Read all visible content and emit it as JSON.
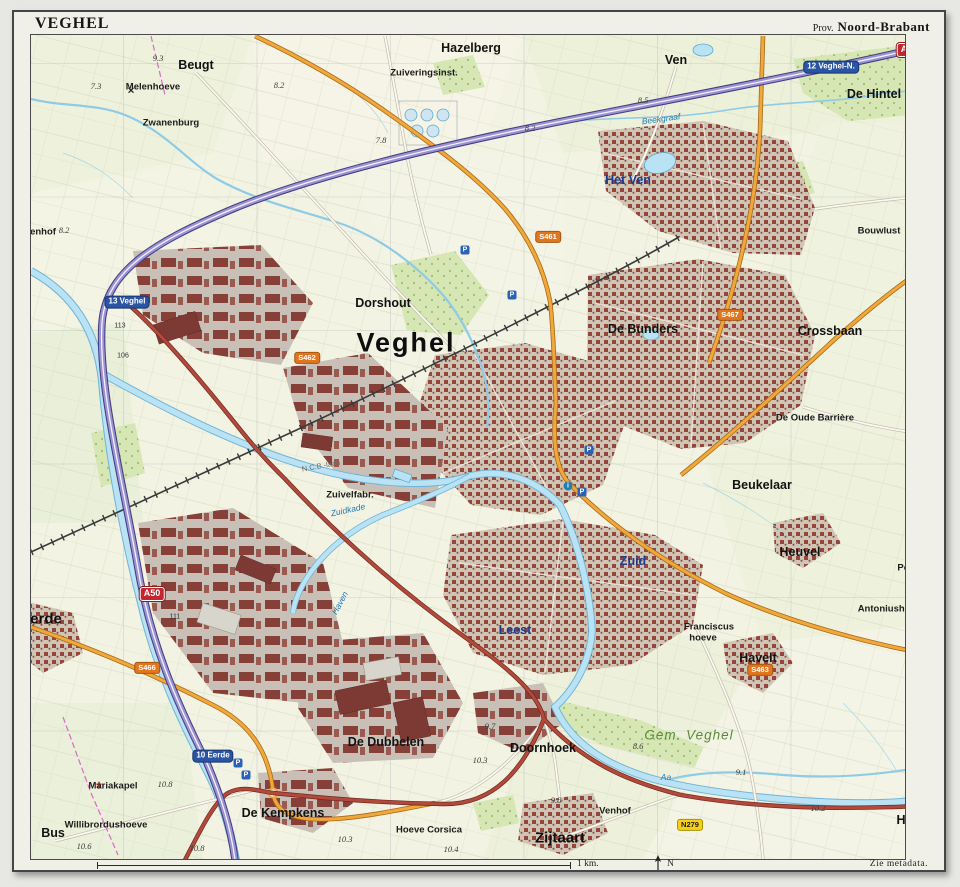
{
  "frame": {
    "title": "VEGHEL",
    "province_prefix": "Prov.",
    "province": "Noord-Brabant",
    "scale_label": "1 km.",
    "north_label": "N",
    "metadata_note": "Zie metadata."
  },
  "colors": {
    "paper": "#f1f0e8",
    "map_base": "#f2f3e3",
    "urban_red": "#96453d",
    "industry_red": "#874038",
    "water": "#b9e3f4",
    "water_edge": "#6fb4d4",
    "motorway_purple": "#9a92d2",
    "main_road_red": "#b3493a",
    "regional_road_orange": "#f0a83d",
    "forest_green": "#d6e6b4",
    "a_shield_red": "#c4262d",
    "n_shield_yellow": "#f6d016",
    "s_shield_orange": "#e2761f",
    "exit_shield_blue": "#2a55a5"
  },
  "map": {
    "labels": [
      {
        "t": "Veghel",
        "x": 403,
        "y": 340,
        "k": "town"
      },
      {
        "t": "Zijtaart",
        "x": 557,
        "y": 835,
        "k": "village"
      },
      {
        "t": "erde",
        "x": 43,
        "y": 616,
        "k": "village"
      },
      {
        "t": "Beugt",
        "x": 193,
        "y": 62,
        "k": "district"
      },
      {
        "t": "Hazelberg",
        "x": 468,
        "y": 45,
        "k": "district"
      },
      {
        "t": "Ven",
        "x": 673,
        "y": 57,
        "k": "district"
      },
      {
        "t": "De Hintel",
        "x": 871,
        "y": 91,
        "k": "district"
      },
      {
        "t": "Dorshout",
        "x": 380,
        "y": 300,
        "k": "district"
      },
      {
        "t": "De Bunders",
        "x": 640,
        "y": 326,
        "k": "district"
      },
      {
        "t": "Crossbaan",
        "x": 827,
        "y": 328,
        "k": "district"
      },
      {
        "t": "Beukelaar",
        "x": 759,
        "y": 482,
        "k": "district"
      },
      {
        "t": "Heuvel",
        "x": 797,
        "y": 549,
        "k": "district"
      },
      {
        "t": "Havelt",
        "x": 755,
        "y": 655,
        "k": "district"
      },
      {
        "t": "De Dubbelen",
        "x": 383,
        "y": 739,
        "k": "district"
      },
      {
        "t": "Doornhoek",
        "x": 540,
        "y": 745,
        "k": "district"
      },
      {
        "t": "De Kempkens",
        "x": 280,
        "y": 810,
        "k": "district"
      },
      {
        "t": "Bus",
        "x": 50,
        "y": 830,
        "k": "district"
      },
      {
        "t": "Ham",
        "x": 907,
        "y": 817,
        "k": "district"
      },
      {
        "t": "Het Ven",
        "x": 625,
        "y": 177,
        "k": "districtblue"
      },
      {
        "t": "Zuid",
        "x": 630,
        "y": 558,
        "k": "districtblue"
      },
      {
        "t": "Leest",
        "x": 512,
        "y": 627,
        "k": "districtblue"
      },
      {
        "t": "Gem. Veghel",
        "x": 686,
        "y": 732,
        "k": "muni"
      },
      {
        "t": "Bouwlust",
        "x": 876,
        "y": 228,
        "k": "hamlet"
      },
      {
        "t": "De Oude Barrière",
        "x": 812,
        "y": 415,
        "k": "hamlet"
      },
      {
        "t": "Pompstat",
        "x": 916,
        "y": 565,
        "k": "hamlet"
      },
      {
        "t": "Antoniushoeve",
        "x": 889,
        "y": 606,
        "k": "hamlet"
      },
      {
        "t": "Franciscus",
        "x": 706,
        "y": 624,
        "k": "hamlet"
      },
      {
        "t": "hoeve",
        "x": 700,
        "y": 635,
        "k": "hamlet"
      },
      {
        "t": "Melenhoeve",
        "x": 150,
        "y": 84,
        "k": "hamlet"
      },
      {
        "t": "Zwanenburg",
        "x": 168,
        "y": 120,
        "k": "hamlet"
      },
      {
        "t": "Zuiveringsinst.",
        "x": 421,
        "y": 70,
        "k": "hamlet"
      },
      {
        "t": "Zuivelfabr.",
        "x": 347,
        "y": 492,
        "k": "hamlet"
      },
      {
        "t": "Mariakapel",
        "x": 110,
        "y": 783,
        "k": "hamlet"
      },
      {
        "t": "Willibrordushoeve",
        "x": 103,
        "y": 822,
        "k": "hamlet"
      },
      {
        "t": "Hoeve Corsica",
        "x": 426,
        "y": 827,
        "k": "hamlet"
      },
      {
        "t": "Venhof",
        "x": 612,
        "y": 808,
        "k": "hamlet"
      },
      {
        "t": "enhof",
        "x": 40,
        "y": 229,
        "k": "hamlet"
      },
      {
        "t": "Aa",
        "x": 663,
        "y": 774,
        "k": "water"
      },
      {
        "t": "Beekgraaf",
        "x": 658,
        "y": 116,
        "k": "water",
        "rot": -8
      },
      {
        "t": "Zuidkade",
        "x": 345,
        "y": 507,
        "k": "water",
        "rot": -12
      },
      {
        "t": "Haven",
        "x": 337,
        "y": 600,
        "k": "water",
        "rot": -62
      },
      {
        "t": "N.C.B.-laan",
        "x": 318,
        "y": 463,
        "k": "street",
        "rot": -10
      },
      {
        "t": "9.3",
        "x": 155,
        "y": 55,
        "k": "height"
      },
      {
        "t": "7.3",
        "x": 93,
        "y": 83,
        "k": "height"
      },
      {
        "t": "8.2",
        "x": 276,
        "y": 82,
        "k": "height"
      },
      {
        "t": "7.8",
        "x": 378,
        "y": 137,
        "k": "height"
      },
      {
        "t": "8.2",
        "x": 527,
        "y": 125,
        "k": "height"
      },
      {
        "t": "8.5",
        "x": 640,
        "y": 97,
        "k": "height"
      },
      {
        "t": "9.7",
        "x": 913,
        "y": 72,
        "k": "height"
      },
      {
        "t": "8.2",
        "x": 61,
        "y": 227,
        "k": "height"
      },
      {
        "t": "9.6",
        "x": 907,
        "y": 312,
        "k": "height"
      },
      {
        "t": "9.7",
        "x": 921,
        "y": 595,
        "k": "height"
      },
      {
        "t": "9.7",
        "x": 487,
        "y": 723,
        "k": "height"
      },
      {
        "t": "10.3",
        "x": 477,
        "y": 757,
        "k": "height"
      },
      {
        "t": "9.8",
        "x": 553,
        "y": 797,
        "k": "height"
      },
      {
        "t": "9.1",
        "x": 738,
        "y": 769,
        "k": "height"
      },
      {
        "t": "8.6",
        "x": 635,
        "y": 743,
        "k": "height"
      },
      {
        "t": "10.2",
        "x": 815,
        "y": 805,
        "k": "height"
      },
      {
        "t": "10.8",
        "x": 162,
        "y": 781,
        "k": "height"
      },
      {
        "t": "10.6",
        "x": 81,
        "y": 843,
        "k": "height"
      },
      {
        "t": "10.3",
        "x": 342,
        "y": 836,
        "k": "height"
      },
      {
        "t": "10.4",
        "x": 448,
        "y": 846,
        "k": "height"
      },
      {
        "t": "10.8",
        "x": 194,
        "y": 845,
        "k": "height"
      },
      {
        "t": "113",
        "x": 117,
        "y": 323,
        "k": "hm"
      },
      {
        "t": "106",
        "x": 120,
        "y": 353,
        "k": "hm"
      },
      {
        "t": "111",
        "x": 172,
        "y": 614,
        "k": "hm"
      }
    ],
    "shields": [
      {
        "t": "A50",
        "x": 906,
        "y": 47,
        "k": "a"
      },
      {
        "t": "A50",
        "x": 149,
        "y": 591,
        "k": "a"
      },
      {
        "t": "N616",
        "x": 918,
        "y": 642,
        "k": "n"
      },
      {
        "t": "N279",
        "x": 687,
        "y": 822,
        "k": "n"
      },
      {
        "t": "S461",
        "x": 545,
        "y": 234,
        "k": "s"
      },
      {
        "t": "S462",
        "x": 304,
        "y": 355,
        "k": "s"
      },
      {
        "t": "S463",
        "x": 757,
        "y": 667,
        "k": "s"
      },
      {
        "t": "S466",
        "x": 144,
        "y": 665,
        "k": "s"
      },
      {
        "t": "S467",
        "x": 727,
        "y": 312,
        "k": "s"
      },
      {
        "t": "12 Veghel-N.",
        "x": 828,
        "y": 64,
        "k": "exit"
      },
      {
        "t": "13 Veghel",
        "x": 124,
        "y": 299,
        "k": "exit"
      },
      {
        "t": "10 Eerde",
        "x": 210,
        "y": 753,
        "k": "exit"
      }
    ],
    "icons": [
      {
        "k": "parking",
        "x": 462,
        "y": 247
      },
      {
        "k": "parking",
        "x": 509,
        "y": 292
      },
      {
        "k": "parking",
        "x": 586,
        "y": 447
      },
      {
        "k": "parking",
        "x": 579,
        "y": 489
      },
      {
        "k": "parking",
        "x": 235,
        "y": 760
      },
      {
        "k": "parking",
        "x": 243,
        "y": 772
      },
      {
        "k": "info",
        "x": 565,
        "y": 483
      },
      {
        "k": "cross",
        "x": 96,
        "y": 783
      },
      {
        "k": "mill",
        "x": 128,
        "y": 88
      }
    ]
  }
}
